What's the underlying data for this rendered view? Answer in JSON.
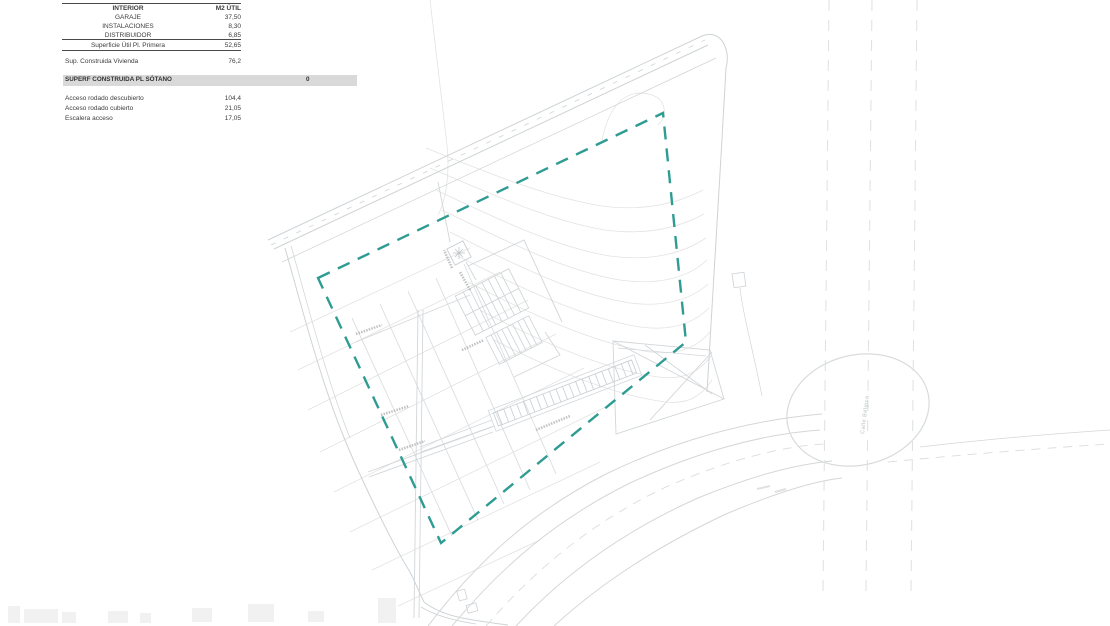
{
  "document": {
    "type_label": "site-plan-sheet"
  },
  "table": {
    "header": {
      "col_interior": "INTERIOR",
      "col_m2util": "M2 ÚTIL"
    },
    "interior_rows": [
      {
        "label": "GARAJE",
        "value": "37,50"
      },
      {
        "label": "INSTALACIONES",
        "value": "8,30"
      },
      {
        "label": "DISTRIBUIDOR",
        "value": "6,85"
      }
    ],
    "subtotal_row": {
      "label": "Superficie Útil Pl. Primera",
      "value": "52,65"
    },
    "vivienda_row": {
      "label": "Sup. Construida Vivienda",
      "value": "76,2"
    },
    "banner_row": {
      "label": "SUPERF CONSTRUIDA PL SÓTANO",
      "value": "0"
    },
    "exterior_rows": [
      {
        "label": "Acceso rodado descubierto",
        "value": "104,4"
      },
      {
        "label": "Acceso rodado cubierto",
        "value": "21,05"
      },
      {
        "label": "Escalera acceso",
        "value": "17,05"
      }
    ]
  },
  "plan": {
    "street_label": "Calle Bélgica",
    "colors": {
      "boundary_teal": "#2E9C92",
      "drawing_gray": "#D6D9DB",
      "contour_gray": "#E3E3E3",
      "banner_gray": "#D9D9D9",
      "annotation_gray": "#B4B4B4"
    }
  }
}
